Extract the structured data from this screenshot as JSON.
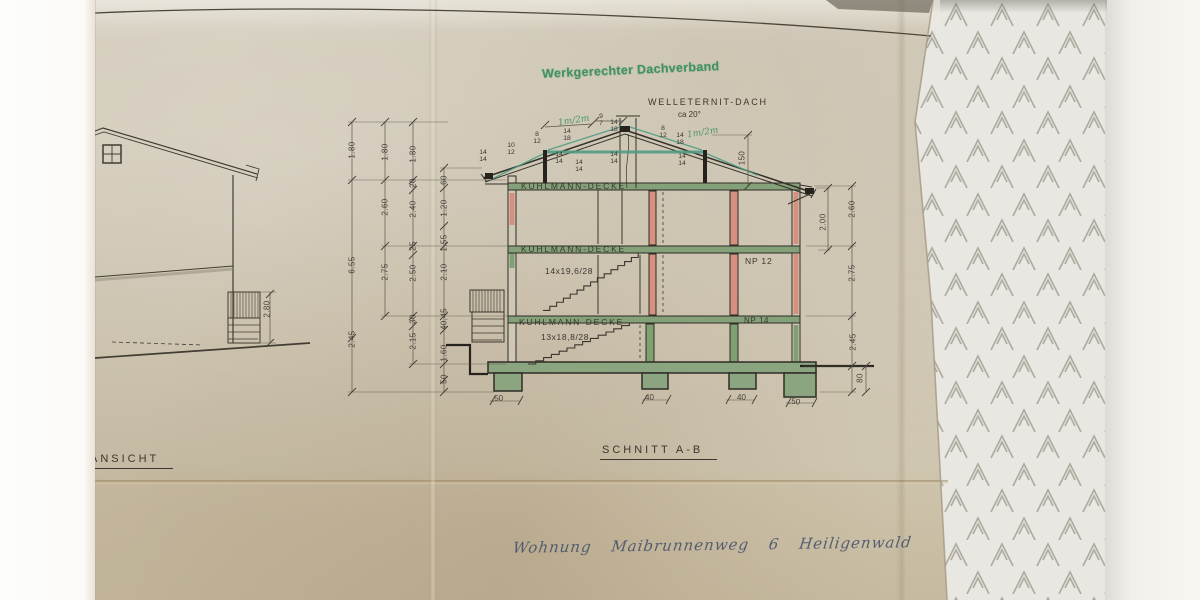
{
  "photo": {
    "stamp": "Werkgerechter Dachverband",
    "handwriting": "Wohnung Maibrunnenweg 6  Heiligenwald"
  },
  "titles": {
    "section": "SCHNITT A-B",
    "elevation": "ANSICHT"
  },
  "roof": {
    "material": "WELLETERNIT-DACH",
    "slope": "ca 20°"
  },
  "labels": {
    "ceiling1": "KUHLMANN-DECKE",
    "ceiling2": "KUHLMANN-DECKE",
    "ceiling3": "KUHLMANN-DECKE",
    "stair_upper": "14x19,6/28",
    "stair_lower": "13x18,8/28",
    "np_upper": "NP 12",
    "np_lower": "NP 14"
  },
  "notes": {
    "green1": "1m/2m",
    "green2": "1m/2m"
  },
  "fractions": [
    {
      "t": "10",
      "b": "12"
    },
    {
      "t": "8",
      "b": "12"
    },
    {
      "t": "14",
      "b": "18"
    },
    {
      "t": "9",
      "b": "7"
    },
    {
      "t": "14",
      "b": "18"
    },
    {
      "t": "8",
      "b": "12"
    },
    {
      "t": "14",
      "b": "18"
    },
    {
      "t": "14",
      "b": "14"
    },
    {
      "t": "14",
      "b": "14"
    },
    {
      "t": "14",
      "b": "14"
    },
    {
      "t": "14",
      "b": "14"
    },
    {
      "t": "14",
      "b": "14"
    }
  ],
  "dims": {
    "col1": [
      "1.80",
      "6.55",
      "2.45"
    ],
    "col2": [
      "1.80",
      "2.60",
      "2.75"
    ],
    "col3": [
      "1.80",
      "20",
      "2.40",
      "25",
      "2.50",
      "30",
      "2.15"
    ],
    "col4": [
      "60",
      "1.20",
      "1.55",
      "2.10",
      "40,45",
      "1.60",
      "50"
    ],
    "right": [
      "150",
      "2.00",
      "2.60",
      "2.75",
      "2.45",
      "80"
    ],
    "bottom": [
      ",50",
      "40",
      "40",
      ",50"
    ],
    "elevation": "2.80"
  }
}
